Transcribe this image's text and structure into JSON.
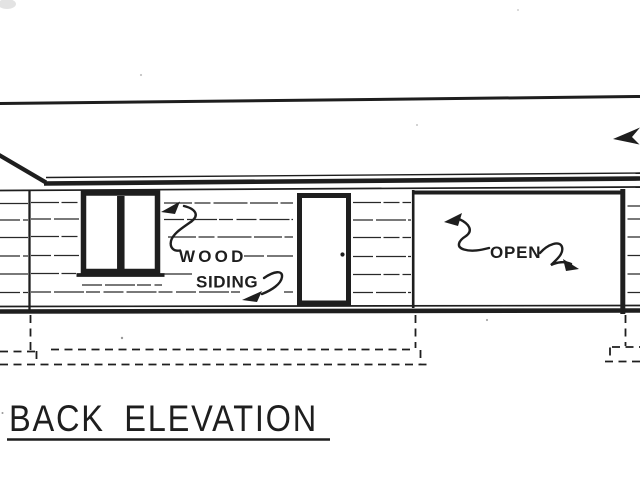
{
  "colors": {
    "ink": "#1e1e1e",
    "paper": "#ffffff"
  },
  "drawing": {
    "title": "BACK ELEVATION",
    "labels": {
      "material_line1": "WOOD",
      "material_line2": "SIDING",
      "opening": "OPEN"
    }
  }
}
